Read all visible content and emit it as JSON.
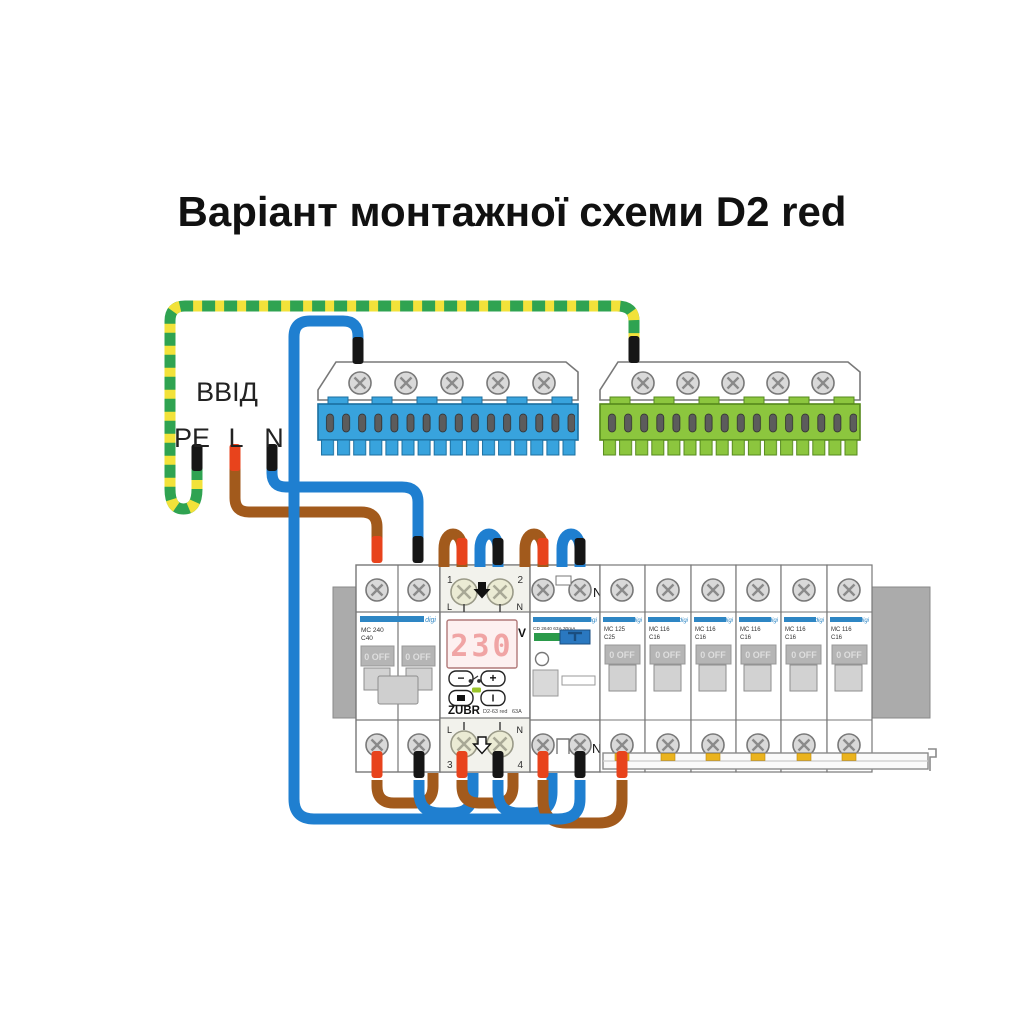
{
  "title": "Варіант монтажної схеми D2 red",
  "input_labels": {
    "name": "ВВІД",
    "pe": "PE",
    "l": "L",
    "n": "N"
  },
  "zubr": {
    "brand": "ZUBR",
    "model": "D2-63 red",
    "rating": "63A",
    "display_value": "230",
    "display_unit": "V",
    "t1": "1",
    "t2": "2",
    "t3": "3",
    "t4": "4",
    "l_top": "L",
    "n_top": "N",
    "l_bottom": "L",
    "n_bottom": "N",
    "btn_minus": "−",
    "btn_plus": "+",
    "btn_start": "I"
  },
  "main_breaker": {
    "line1": "MC 240",
    "line2": "C40"
  },
  "rcd": {
    "label": "CD 2640 63A 30mA",
    "n_top": "N",
    "n_bottom": "N"
  },
  "dist_breakers": [
    {
      "line1": "MC 125",
      "line2": "C25"
    },
    {
      "line1": "MC 116",
      "line2": "C16"
    },
    {
      "line1": "MC 116",
      "line2": "C16"
    },
    {
      "line1": "MC 116",
      "line2": "C16"
    },
    {
      "line1": "MC 116",
      "line2": "C16"
    },
    {
      "line1": "MC 116",
      "line2": "C16"
    }
  ],
  "common": {
    "off": "0 OFF",
    "brand": "digi"
  },
  "colors": {
    "wire_blue": "#1f7fd0",
    "wire_brown": "#a25a1c",
    "pe_green": "#2fa351",
    "pe_yellow": "#f2e23a",
    "ferrule_red": "#e8431c",
    "ferrule_black": "#161616",
    "bus_blue": "#38a3dd",
    "bus_green": "#8cc63e",
    "breaker_stripe": "#2e86c4",
    "display_digits": "#f0a4a4",
    "rcd_indicator_green": "#2a9a4a",
    "rcd_toggle_blue": "#2a78c0"
  }
}
